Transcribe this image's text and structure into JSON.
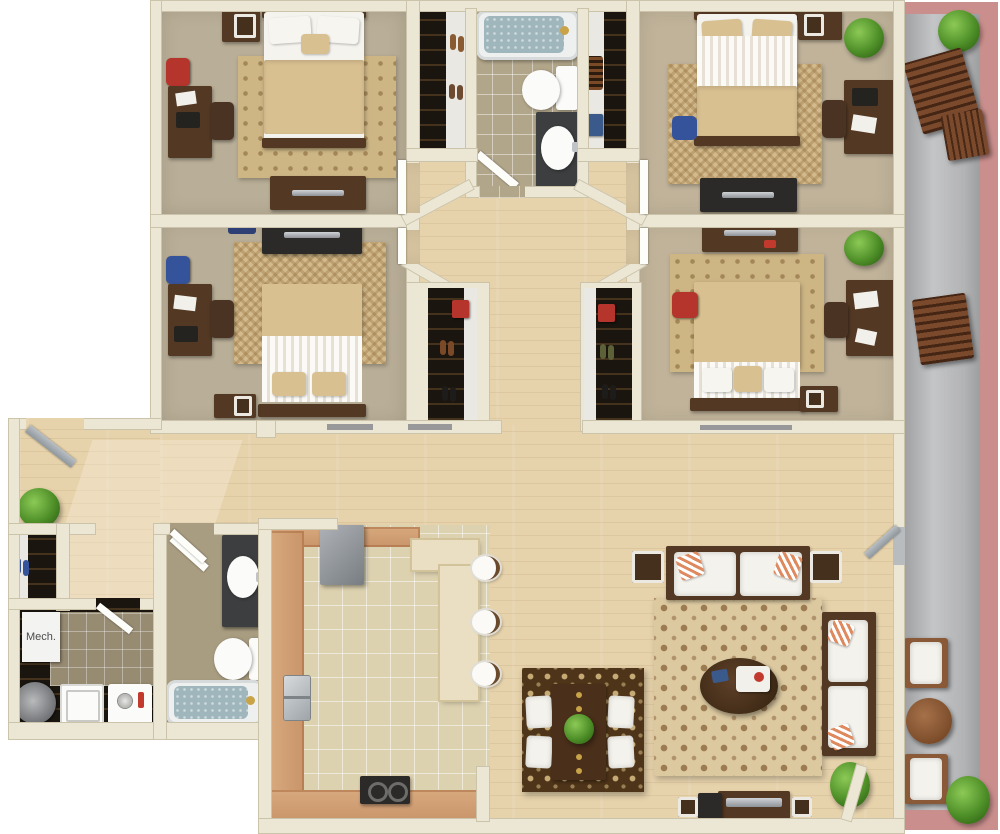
{
  "labels": {
    "mech": "Mech."
  },
  "palette": {
    "wall": "#ece7d4",
    "wood": "#e6d2ab",
    "carpet": "#b9ae97",
    "carpet_right": "#c0b39a",
    "tile": "#ddd2b0",
    "bath_tile": "#b2a68a",
    "closet": "#1a150f",
    "dark_wood": "#533923",
    "rug_tan": "#cdb584",
    "rug_damask": "#dcc9a0",
    "rug_dining": "#4e3418",
    "counter": "#d8a97e",
    "island": "#eadfc2",
    "water": "#9fb6bc",
    "balcony_trim": "#ca8f8d",
    "concrete": "#adaeb0",
    "plant_green": "#4e8f28",
    "accent_red": "#b5342c",
    "accent_blue": "#35539a"
  }
}
